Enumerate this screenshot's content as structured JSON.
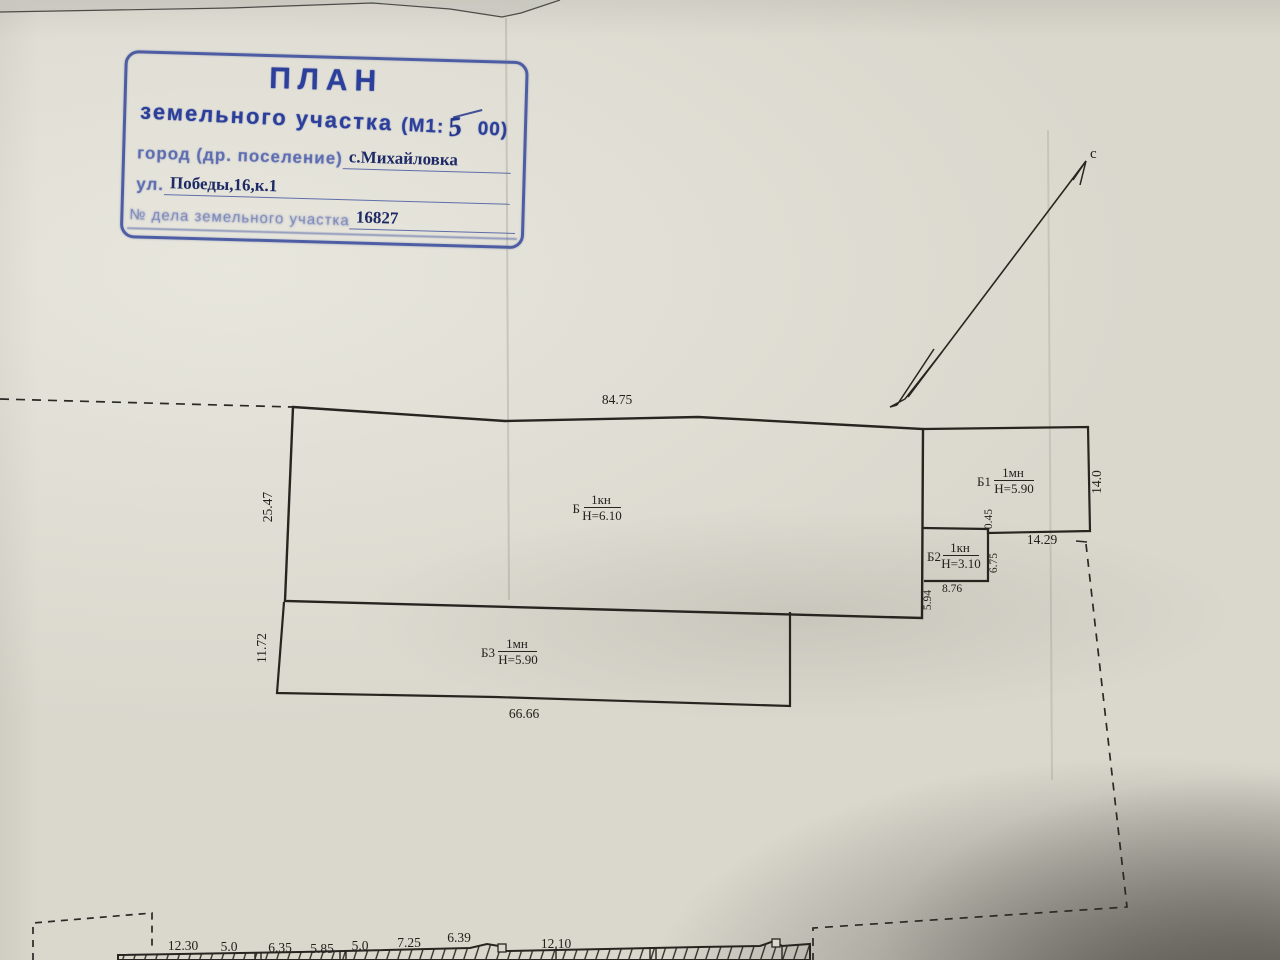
{
  "stamp": {
    "title": "ПЛАН",
    "subtitle": "земельного участка",
    "scale_prefix": "(М1:",
    "scale_handwritten": "5",
    "scale_suffix": "00)",
    "fields": [
      {
        "label": "город (др. поселение)",
        "value": "с.Михайловка"
      },
      {
        "label": "ул.",
        "value": "Победы,16,к.1"
      },
      {
        "label": "№ дела земельного участка",
        "value": "16827"
      }
    ]
  },
  "north": {
    "label": "с"
  },
  "buildings": [
    {
      "id": "Б",
      "type": "1кн",
      "height": "Н=6.10"
    },
    {
      "id": "Б1",
      "type": "1мн",
      "height": "Н=5.90"
    },
    {
      "id": "Б2",
      "type": "1кн",
      "height": "Н=3.10"
    },
    {
      "id": "Б3",
      "type": "1мн",
      "height": "Н=5.90"
    }
  ],
  "dimensions": {
    "b_top": "84.75",
    "b_left": "25.47",
    "b3_left": "11.72",
    "b3_bottom": "66.66",
    "b1_right": "14.0",
    "b1_bottom": "14.29",
    "b1_jog": "0.45",
    "b2_right": "6.75",
    "b2_bottom": "8.76",
    "b2_left": "5.94"
  },
  "street_dimensions": [
    "12.30",
    "5.0",
    "6.35",
    "5.85",
    "5.0",
    "7.25",
    "6.39",
    "12.10"
  ],
  "colors": {
    "stamp_blue": "#2b3f9b",
    "ink": "#26251f",
    "paper": "#dad8cd"
  }
}
